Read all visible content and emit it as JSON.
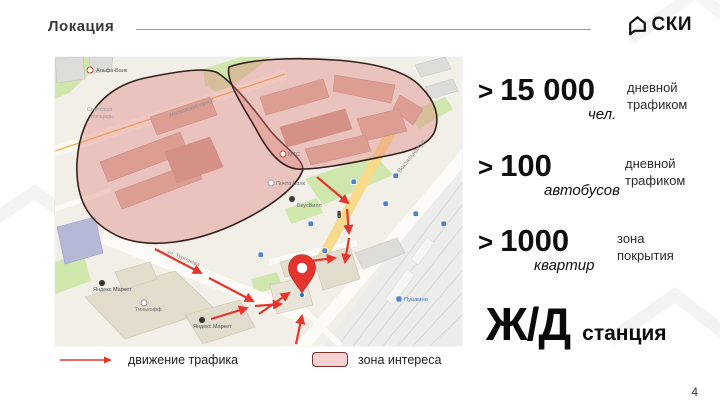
{
  "slide": {
    "title": "Локация",
    "page_number": "4"
  },
  "logo": {
    "text": "СКИ"
  },
  "stats": [
    {
      "prefix": ">",
      "value": "15 000",
      "unit": "чел.",
      "desc_line1": "дневной",
      "desc_line2": "трафиком"
    },
    {
      "prefix": ">",
      "value": "100",
      "unit": "автобусов",
      "desc_line1": "дневной",
      "desc_line2": "трафиком"
    },
    {
      "prefix": ">",
      "value": "1000",
      "unit": "квартир",
      "desc_line1": "зона",
      "desc_line2": "покрытия"
    }
  ],
  "station": {
    "big": "Ж/Д",
    "small": "станция"
  },
  "legend": {
    "traffic_label": "движение трафика",
    "interest_label": "зона интереса"
  },
  "map": {
    "street_labels": [
      {
        "text": "Московский просп."
      },
      {
        "text": "ул. Тургенева"
      },
      {
        "text": "Вокзальная ул."
      },
      {
        "text": "Советская"
      },
      {
        "text": "площадь"
      }
    ],
    "poi_labels": [
      {
        "text": "Альфа-Банк"
      },
      {
        "text": "Почта Банк"
      },
      {
        "text": "МТС"
      },
      {
        "text": "ВкусВилл"
      },
      {
        "text": "Яндекс Маркет"
      },
      {
        "text": "Яндекс Маркет"
      },
      {
        "text": "Тинькофф"
      },
      {
        "text": "Пушкино"
      }
    ],
    "colors": {
      "zone_fill": "#e2837c",
      "zone_border": "#33211c",
      "arrow": "#e8352c",
      "pin": "#e5332d"
    }
  }
}
